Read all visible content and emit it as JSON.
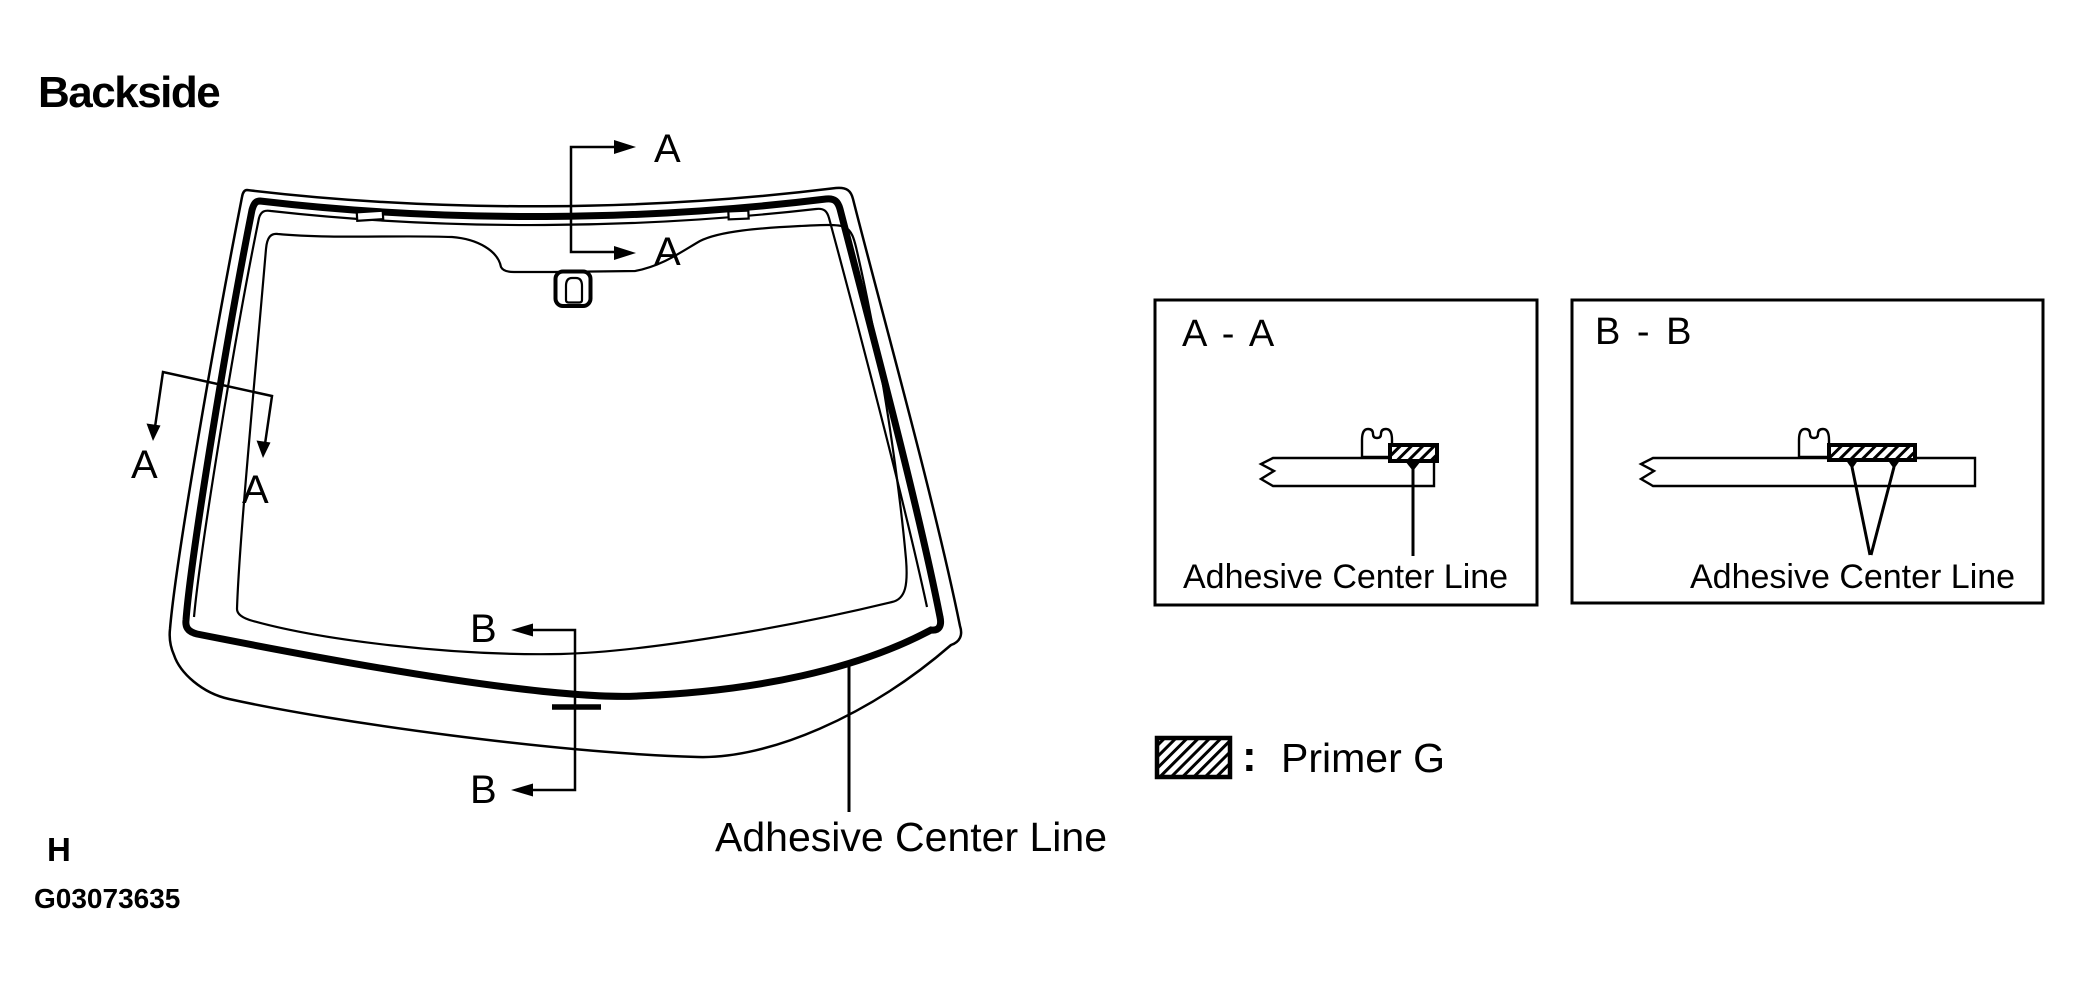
{
  "header": {
    "title": "Backside"
  },
  "windshield": {
    "section_a": {
      "letter": "A"
    },
    "section_b": {
      "letter": "B"
    },
    "adhesive_label": "Adhesive Center Line"
  },
  "panels": {
    "aa": {
      "title": "A - A",
      "adhesive_label": "Adhesive Center Line"
    },
    "bb": {
      "title": "B - B",
      "adhesive_label": "Adhesive Center Line"
    }
  },
  "legend": {
    "colon": ":",
    "label": "Primer G",
    "swatch": "hatch-primer-swatch"
  },
  "footer": {
    "page_marker": "H",
    "figure_id": "G03073635"
  },
  "colors": {
    "ink": "#000000",
    "background": "#ffffff"
  }
}
